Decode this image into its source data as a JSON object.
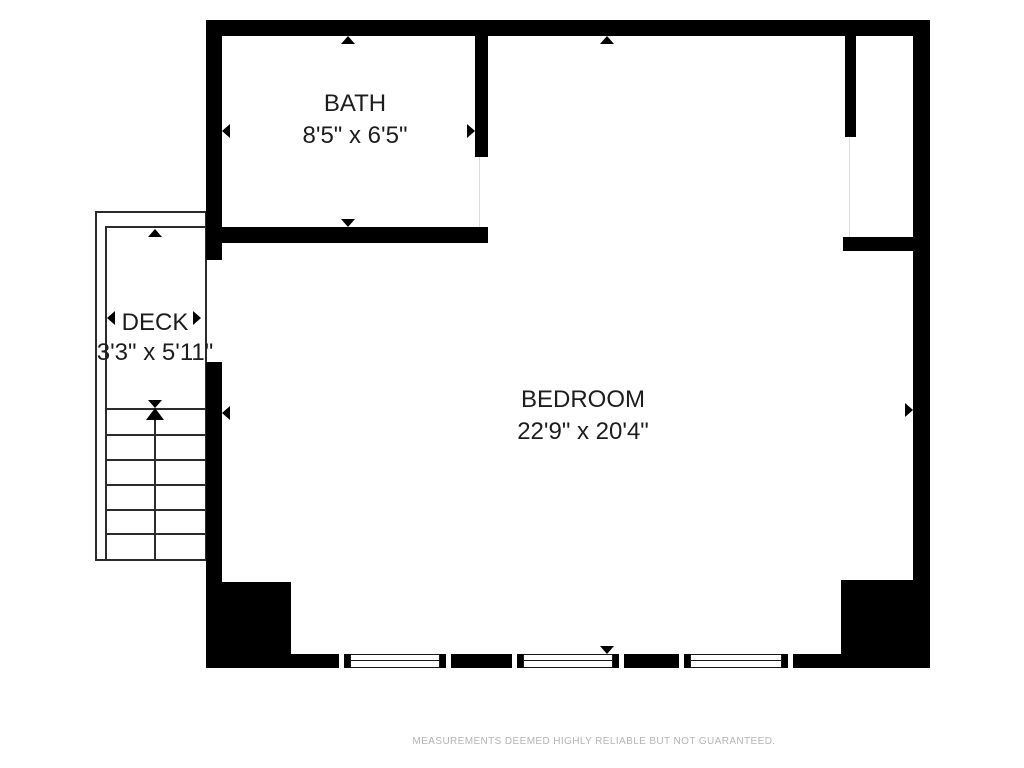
{
  "title": "Floor plan",
  "rooms": [
    {
      "name": "BATH",
      "dimensions": "8'5\" x 6'5\""
    },
    {
      "name": "DECK",
      "dimensions": "3'3\" x 5'11\""
    },
    {
      "name": "BEDROOM",
      "dimensions": "22'9\" x 20'4\""
    }
  ],
  "disclaimer": "MEASUREMENTS DEEMED HIGHLY RELIABLE BUT NOT GUARANTEED.",
  "features": {
    "staircase": {
      "treads": 6,
      "direction": "up"
    },
    "windows_bottom_wall": 3,
    "door_openings": [
      "deck-to-bedroom",
      "bath-to-bedroom",
      "closet-to-bedroom"
    ]
  },
  "colors": {
    "wall": "#000000",
    "background": "#ffffff",
    "thin_line": "#2b2b2b",
    "label_text": "#1d1d1d",
    "disclaimer_text": "#b4b4b4"
  }
}
